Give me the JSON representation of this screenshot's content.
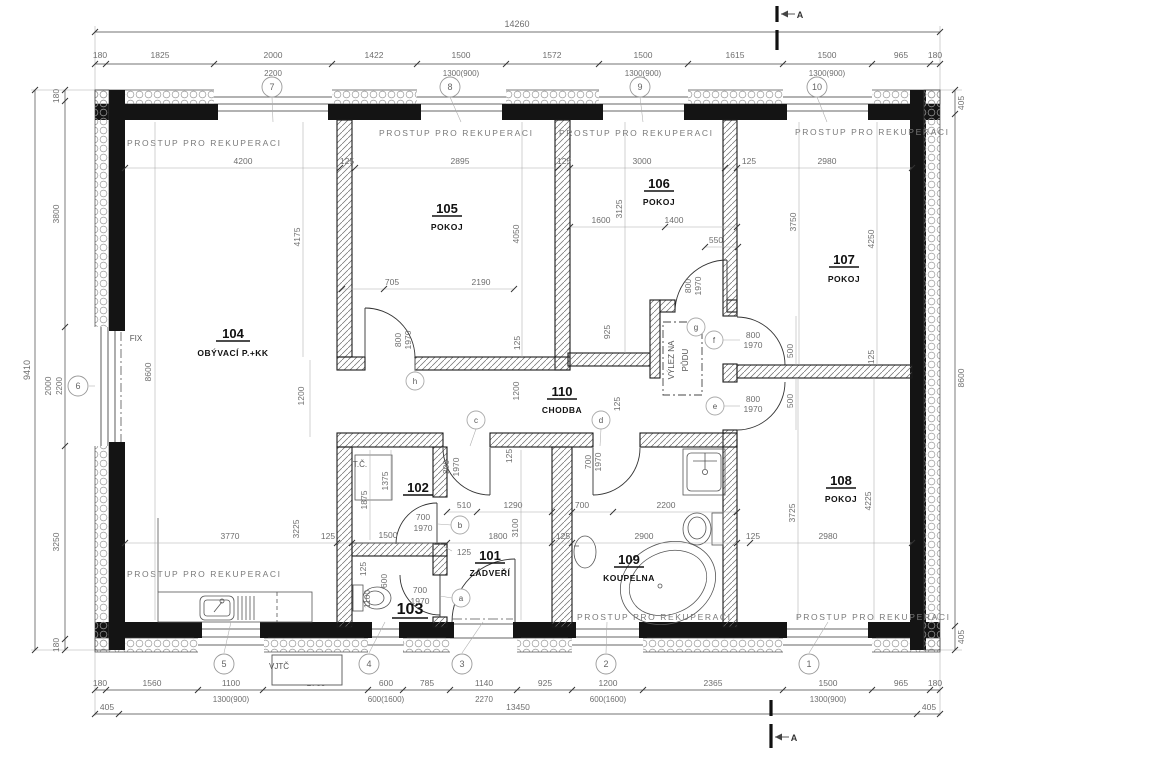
{
  "rooms": {
    "r101": {
      "num": "101",
      "name": "ZÁDVEŘÍ"
    },
    "r102": {
      "num": "102",
      "name": ""
    },
    "r103": {
      "num": "103",
      "name": ""
    },
    "r104": {
      "num": "104",
      "name": "OBÝVACÍ P.+KK"
    },
    "r105": {
      "num": "105",
      "name": "POKOJ"
    },
    "r106": {
      "num": "106",
      "name": "POKOJ"
    },
    "r107": {
      "num": "107",
      "name": "POKOJ"
    },
    "r108": {
      "num": "108",
      "name": "POKOJ"
    },
    "r109": {
      "num": "109",
      "name": "KOUPELNA"
    },
    "r110": {
      "num": "110",
      "name": "CHODBA"
    }
  },
  "annotations": {
    "recuperation": "PROSTUP PRO REKUPERACI",
    "fix": "FIX",
    "heat_pump": "T.Č.",
    "vjtc": "VJTČ",
    "attic_line1": "VÝLEZ NA",
    "attic_line2": "PŮDU",
    "section": "A"
  },
  "grid": {
    "n1": "1",
    "n2": "2",
    "n3": "3",
    "n4": "4",
    "n5": "5",
    "n6": "6",
    "n7": "7",
    "n8": "8",
    "n9": "9",
    "n10": "10"
  },
  "tags": {
    "a": "a",
    "b": "b",
    "c": "c",
    "d": "d",
    "e": "e",
    "f": "f",
    "g": "g",
    "h": "h"
  },
  "dims": {
    "top_total": "14260",
    "top": [
      "180",
      "1825",
      "2000",
      "1422",
      "1500",
      "1572",
      "1500",
      "1615",
      "1500",
      "965",
      "180"
    ],
    "top_sub": [
      "2200",
      "1300(900)",
      "1300(900)",
      "1300(900)"
    ],
    "left_total": "9410",
    "left": [
      "180",
      "3800",
      "2000",
      "3250",
      "180"
    ],
    "left_sub": "2200",
    "right": [
      "405",
      "8600",
      "405"
    ],
    "bottom": [
      "180",
      "1560",
      "1100",
      "1760",
      "600",
      "785",
      "1140",
      "925",
      "1200",
      "2365",
      "1500",
      "965",
      "180"
    ],
    "bottom_sub": [
      "1300(900)",
      "600(1600)",
      "2270",
      "600(1600)",
      "1300(900)"
    ],
    "bottom2": [
      "405",
      "13450",
      "405"
    ],
    "inner": {
      "v125": "125",
      "v500": "500",
      "v510": "510",
      "v550": "550",
      "v600": "600",
      "v700": "700",
      "v705": "705",
      "v800": "800",
      "v925": "925",
      "v1100": "1100",
      "v1200": "1200",
      "v1290": "1290",
      "v1375": "1375",
      "v1400": "1400",
      "v1500": "1500",
      "v1600": "1600",
      "v1800": "1800",
      "v1875": "1875",
      "v1970": "1970",
      "v2190": "2190",
      "v2200": "2200",
      "v2895": "2895",
      "v2900": "2900",
      "v2980": "2980",
      "v3000": "3000",
      "v3100": "3100",
      "v3125": "3125",
      "v3225": "3225",
      "v3725": "3725",
      "v3750": "3750",
      "v3770": "3770",
      "v4050": "4050",
      "v4175": "4175",
      "v4200": "4200",
      "v4225": "4225",
      "v4250": "4250",
      "v8600": "8600"
    }
  }
}
